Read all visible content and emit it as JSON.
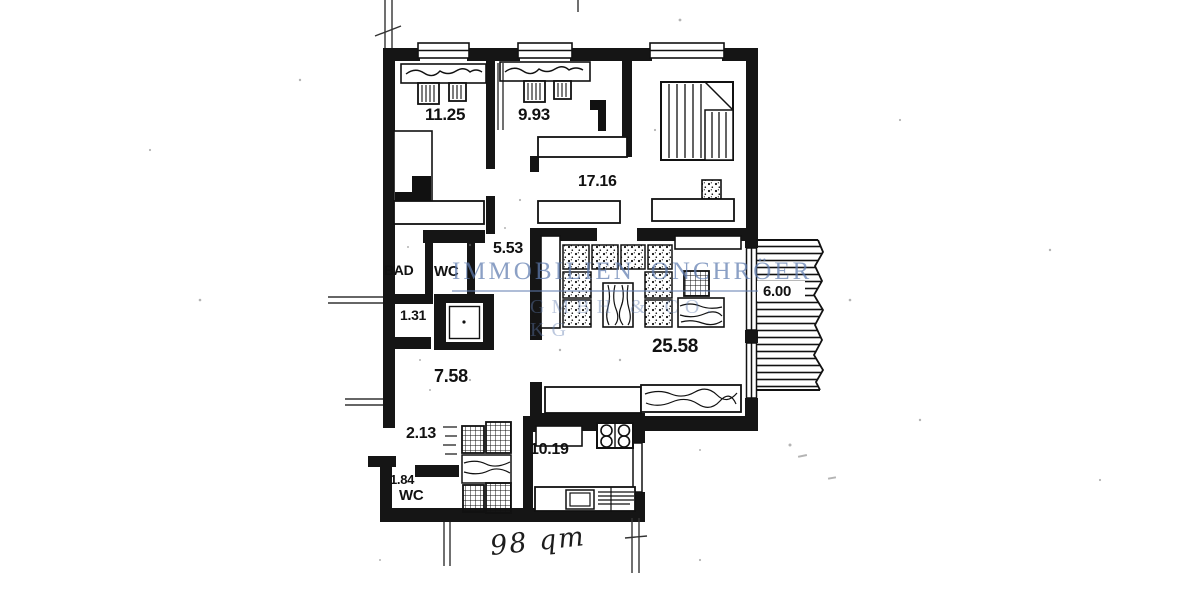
{
  "document": {
    "type": "apartment floor plan (scanned)",
    "handwritten_note": "98 qm"
  },
  "rooms": [
    {
      "name": "bedroom-1",
      "label": "11.25"
    },
    {
      "name": "bedroom-2",
      "label": "9.93"
    },
    {
      "name": "living-dining",
      "label": "17.16"
    },
    {
      "name": "hall",
      "label": "5.53"
    },
    {
      "name": "bath",
      "label": "BAD"
    },
    {
      "name": "wc",
      "label": "WC"
    },
    {
      "name": "storage",
      "label": "1.31"
    },
    {
      "name": "hallway",
      "label": "7.58"
    },
    {
      "name": "corridor",
      "label": "2.13"
    },
    {
      "name": "wc2-size",
      "label": "1.84"
    },
    {
      "name": "wc2",
      "label": "WC"
    },
    {
      "name": "kitchen",
      "label": "10.19"
    },
    {
      "name": "living-room",
      "label": "25.58"
    },
    {
      "name": "balcony",
      "label": "6.00"
    }
  ],
  "watermark": {
    "line1_left": "IMMOBILIEN",
    "line1_right": "ONCHRÖER",
    "line2": "GMBH & CO. KG",
    "color": "#5f7cb0"
  },
  "colors": {
    "ink": "#151515",
    "paper": "#ffffff"
  }
}
